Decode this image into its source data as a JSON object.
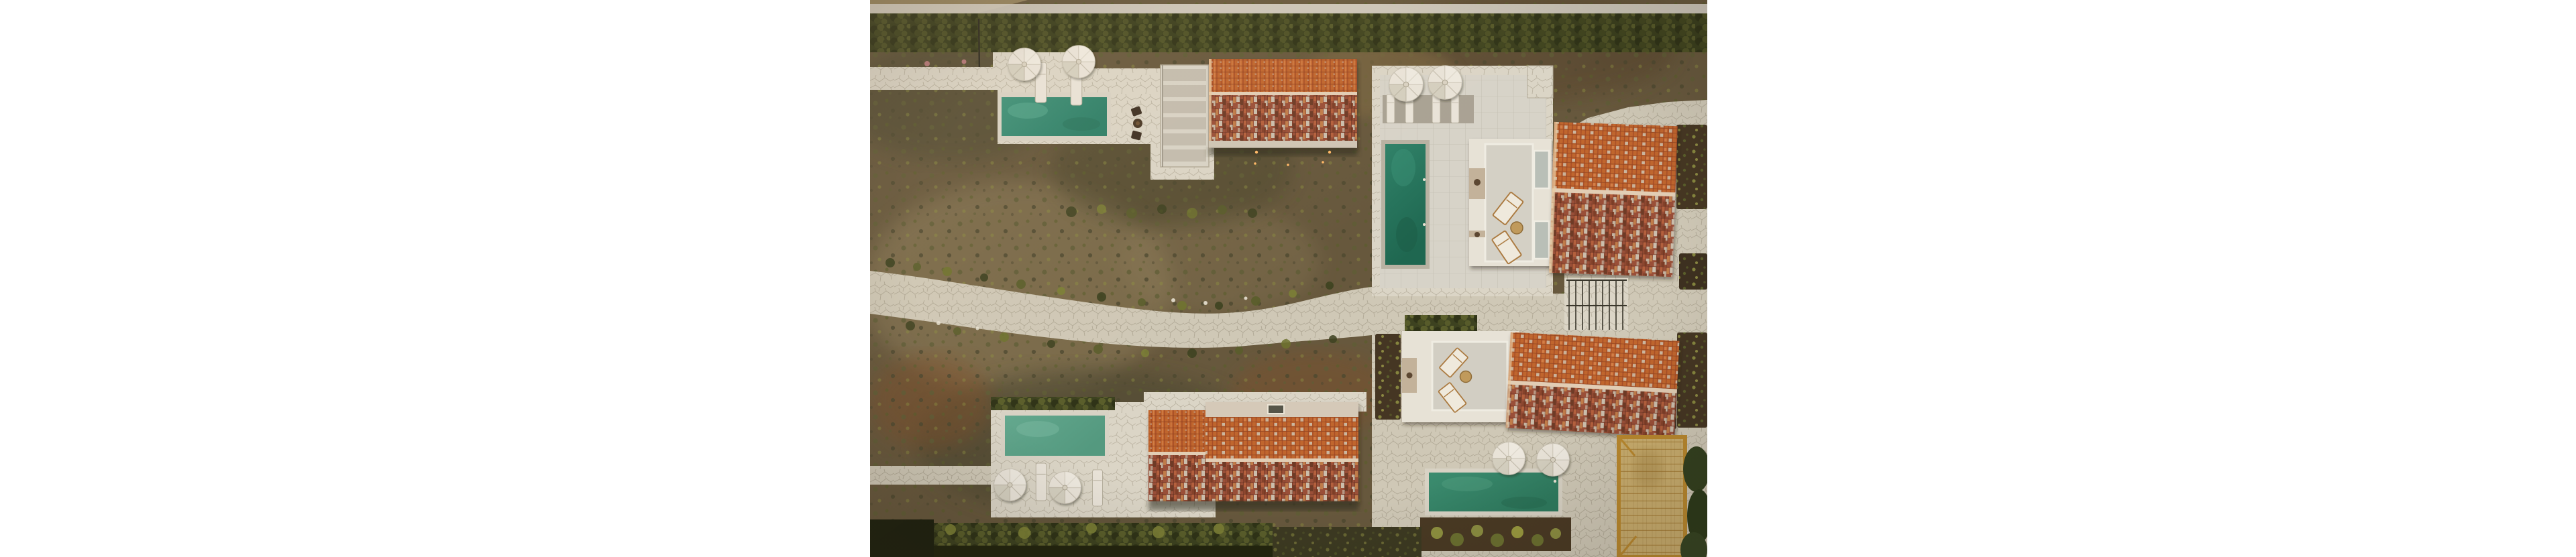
{
  "page": {
    "background": "#ffffff"
  },
  "photo": {
    "description": "Aerial drone photograph of a Mediterranean villa resort: four stone terraces with green swimming pools, white patio umbrellas and sun loungers, terracotta tiled roofs with weathered white patches, white flat-roofed buildings with roof terraces, a winding flagstone path through dry scrubland gardens, hedge rows, a bamboo-covered pergola deck and small garden beds.",
    "scene": {
      "type": "aerial-photo",
      "villas": [
        {
          "id": "top-left",
          "pool_color_key": "pool1",
          "umbrellas": 2,
          "loungers": 2,
          "features": [
            "slatted-pergola",
            "bistro-set",
            "terracotta-roof",
            "path-lights"
          ]
        },
        {
          "id": "center",
          "pool_color_key": "pool2",
          "umbrellas": 2,
          "loungers": 4,
          "features": [
            "roof-terrace",
            "two-roof-loungers",
            "round-table",
            "terracotta-roof",
            "staircase-with-railing"
          ]
        },
        {
          "id": "bottom-left",
          "pool_color_key": "pool3",
          "umbrellas": 2,
          "loungers": 2,
          "features": [
            "double-terracotta-roof",
            "flat-roof-strip",
            "skylight"
          ]
        },
        {
          "id": "bottom-right",
          "pool_color_key": "pool4",
          "umbrellas": 2,
          "loungers": 2,
          "features": [
            "roof-terrace",
            "tilted-terracotta-roof",
            "bamboo-pergola-deck",
            "garden-beds"
          ]
        }
      ],
      "landscape": [
        "scrubland-garden",
        "winding-flagstone-path",
        "top-hedge-row",
        "bottom-hedge-row",
        "stone-pavement",
        "sandy-patches"
      ]
    },
    "colors": {
      "scrub-base": "#67583d",
      "scrub-dark": "#4e4830",
      "scrub-olive": "#5f5d36",
      "scrub-light": "#8a7957",
      "sand": "#97855f",
      "rust": "#7d4f2c",
      "hedge-dark": "#3d4220",
      "hedge-mid": "#5a5e2b",
      "hedge-light": "#8c8e41",
      "flower-pink": "#b47878",
      "stone": "#cfc8b6",
      "stone-joint": "#a59d8a",
      "stone-bright": "#dbd5c6",
      "concrete": "#d7d3c8",
      "white-wall": "#e7e2d6",
      "recess": "#c3b29a",
      "pool1": "#3f9179",
      "pool1-deep": "#2e7f68",
      "pool2": "#2f8168",
      "pool2-deep": "#1f6750",
      "pool3": "#63a88e",
      "pool3-deep": "#54997f",
      "pool4": "#3c8c6f",
      "pool4-deep": "#2e7a5e",
      "coping": "#d8d2c4",
      "roof-orange": "#c0662f",
      "roof-orange-dark": "#a84e26",
      "roof-orange-light": "#d8854e",
      "roof-mottle-base": "#9a5038",
      "roof-white": "#cdc4b2",
      "roof-dark": "#6e3a26",
      "ridge": "#e2cdb4",
      "umbrella": "#e9e3d8",
      "umbrella-seam": "#c6bfb0",
      "deck": "#c9ad6e",
      "deck-frame": "#b9882e",
      "deck-line": "#a8803a",
      "wood": "#ab7a40",
      "shadow": "#2c2a1c",
      "light-dot": "#ffb866",
      "window": "#b9bfb7",
      "rail": "#3a372c"
    }
  }
}
